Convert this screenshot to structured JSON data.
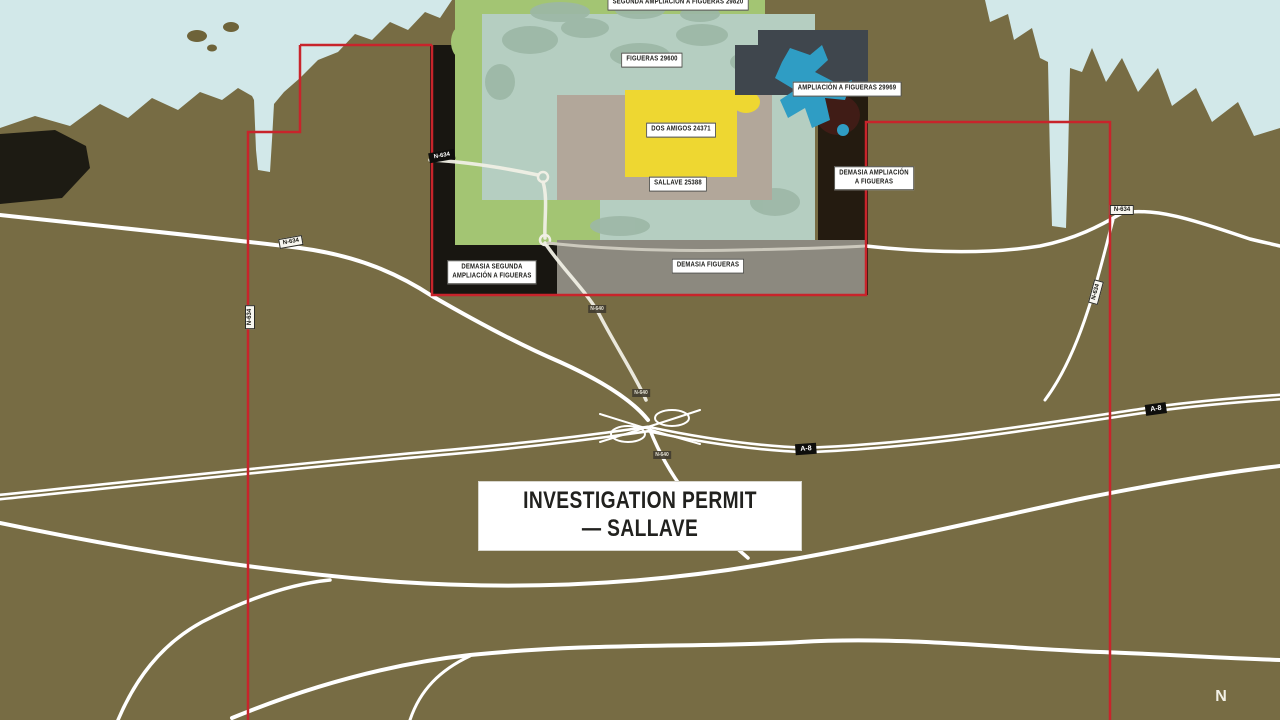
{
  "map_title": {
    "text": "INVESTIGATION PERMIT — SALLAVE"
  },
  "compass": {
    "north": "N"
  },
  "environment": {
    "sea_color": "#d2e8e9",
    "land_color": "#776c44",
    "road_color": "#ffffff"
  },
  "boundary": {
    "color": "#c8242b",
    "name": "Investigation permit boundary"
  },
  "permit_areas": {
    "segunda_ampliacion_a_figueras": {
      "label": "SEGUNDA AMPLIACIÓN A FIGUERAS 29820",
      "color": "#a3c573"
    },
    "figueras": {
      "label": "FIGUERAS 29600",
      "color": "#b5cec1"
    },
    "ampliacion_a_figueras": {
      "label": "AMPLIACIÓN A FIGUERAS 29969",
      "color": "#2f9dc4"
    },
    "dos_amigos": {
      "label": "DOS AMIGOS 24371",
      "color": "#eed731"
    },
    "sallave": {
      "label": "SALLAVE 25388",
      "color": "#b2a79a"
    },
    "demasia_ampliacion_a_figueras": {
      "line1": "DEMASIA AMPLIACIÓN",
      "line2": "A FIGUERAS",
      "color": "#241b10"
    },
    "demasia_segunda_ampliacion_a_figueras": {
      "line1": "DEMASIA SEGUNDA",
      "line2": "AMPLIACIÓN A FIGUERAS",
      "color": "#1b1912"
    },
    "demasia_figueras": {
      "label": "DEMASIA FIGUERAS",
      "color": "#8c897f"
    },
    "ampliacion_dark_zone_color": "#3f464d"
  },
  "road_badges": [
    {
      "id": "n634-west",
      "text": "N-634"
    },
    {
      "id": "n634-west-lower",
      "text": "N-634"
    },
    {
      "id": "n634-inside-permit",
      "text": "N-634"
    },
    {
      "id": "n640-north-of-a8",
      "text": "N-640"
    },
    {
      "id": "n640-junction-north",
      "text": "N-640"
    },
    {
      "id": "n640-junction-south",
      "text": "N-640"
    },
    {
      "id": "a8-center",
      "text": "A-8"
    },
    {
      "id": "a8-east",
      "text": "A-8"
    },
    {
      "id": "n634-east",
      "text": "N-634"
    },
    {
      "id": "n634-east-lower",
      "text": "N-634"
    }
  ]
}
